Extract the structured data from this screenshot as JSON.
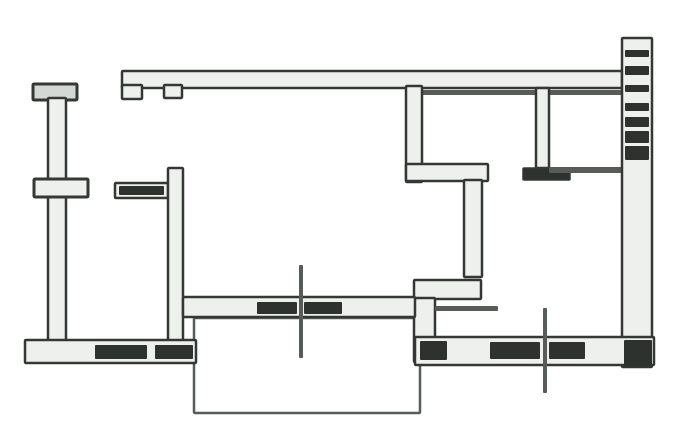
{
  "canvas": {
    "width": 697,
    "height": 446,
    "bg": "#ffffff"
  },
  "palette": {
    "paper": "#ffffff",
    "ink": "#343834",
    "ink_soft": "#575c58",
    "band": "#eef0ee",
    "band_shade": "#d4d8d4",
    "dark": "#2e322e"
  },
  "floorplan": {
    "kind": "apartment-floor-plan",
    "shapes": [
      {
        "name": "balcony-outline",
        "type": "band",
        "x": 194,
        "y": 318,
        "w": 226,
        "h": 95,
        "fill": "paper",
        "stroke": "ink_soft",
        "sw": 2.5
      },
      {
        "name": "top-exterior-wall",
        "type": "band",
        "x": 122,
        "y": 71,
        "w": 500,
        "h": 17,
        "fill": "band",
        "stroke": "ink",
        "sw": 2.5
      },
      {
        "name": "top-wall-left-jamb",
        "type": "band",
        "x": 122,
        "y": 85,
        "w": 20,
        "h": 14,
        "fill": "band",
        "stroke": "ink",
        "sw": 2.5
      },
      {
        "name": "top-wall-second-jamb",
        "type": "band",
        "x": 164,
        "y": 85,
        "w": 18,
        "h": 13,
        "fill": "band",
        "stroke": "ink",
        "sw": 2.5
      },
      {
        "name": "top-wall-inner-line",
        "type": "fill",
        "x": 420,
        "y": 90,
        "w": 202,
        "h": 5,
        "fill": "ink_soft"
      },
      {
        "name": "left-wall-top-cap",
        "type": "band",
        "x": 33,
        "y": 84,
        "w": 44,
        "h": 16,
        "fill": "band_shade",
        "stroke": "ink",
        "sw": 3
      },
      {
        "name": "left-exterior-wall",
        "type": "band",
        "x": 48,
        "y": 98,
        "w": 18,
        "h": 246,
        "fill": "band",
        "stroke": "ink",
        "sw": 2.5
      },
      {
        "name": "left-wall-pier",
        "type": "band",
        "x": 34,
        "y": 179,
        "w": 54,
        "h": 18,
        "fill": "band",
        "stroke": "ink",
        "sw": 3
      },
      {
        "name": "entry-wall-segment",
        "type": "band",
        "x": 115,
        "y": 183,
        "w": 53,
        "h": 15,
        "fill": "band",
        "stroke": "ink",
        "sw": 2.5
      },
      {
        "name": "entry-wall-fill",
        "type": "fill",
        "x": 119,
        "y": 186,
        "w": 45,
        "h": 9,
        "fill": "dark"
      },
      {
        "name": "hall-partition-wall",
        "type": "band",
        "x": 168,
        "y": 168,
        "w": 15,
        "h": 175,
        "fill": "band",
        "stroke": "ink",
        "sw": 2.5
      },
      {
        "name": "bottom-left-exterior-wall",
        "type": "band",
        "x": 25,
        "y": 340,
        "w": 171,
        "h": 23,
        "fill": "band",
        "stroke": "ink",
        "sw": 2.5
      },
      {
        "name": "bottom-left-window-fill-a",
        "type": "fill",
        "x": 95,
        "y": 345,
        "w": 52,
        "h": 14,
        "fill": "dark"
      },
      {
        "name": "bottom-left-window-fill-b",
        "type": "fill",
        "x": 155,
        "y": 345,
        "w": 38,
        "h": 14,
        "fill": "dark"
      },
      {
        "name": "kitchen-partition-wall",
        "type": "band",
        "x": 406,
        "y": 86,
        "w": 16,
        "h": 96,
        "fill": "band",
        "stroke": "ink",
        "sw": 2.5
      },
      {
        "name": "kitchen-lower-wall",
        "type": "band",
        "x": 406,
        "y": 164,
        "w": 82,
        "h": 17,
        "fill": "band",
        "stroke": "ink",
        "sw": 2.5
      },
      {
        "name": "corridor-wall",
        "type": "band",
        "x": 464,
        "y": 180,
        "w": 18,
        "h": 97,
        "fill": "band",
        "stroke": "ink",
        "sw": 2.5
      },
      {
        "name": "corridor-step-wall",
        "type": "band",
        "x": 414,
        "y": 280,
        "w": 67,
        "h": 19,
        "fill": "band",
        "stroke": "ink",
        "sw": 2.5
      },
      {
        "name": "corridor-step-wall-lower",
        "type": "band",
        "x": 414,
        "y": 298,
        "w": 21,
        "h": 64,
        "fill": "band",
        "stroke": "ink",
        "sw": 2.5
      },
      {
        "name": "threshold-line",
        "type": "fill",
        "x": 435,
        "y": 306,
        "w": 63,
        "h": 5,
        "fill": "ink_soft"
      },
      {
        "name": "living-room-south-wall",
        "type": "band",
        "x": 183,
        "y": 297,
        "w": 232,
        "h": 20,
        "fill": "band",
        "stroke": "ink",
        "sw": 2.5
      },
      {
        "name": "south-wall-window-fill-a",
        "type": "fill",
        "x": 257,
        "y": 302,
        "w": 40,
        "h": 12,
        "fill": "dark"
      },
      {
        "name": "south-wall-window-fill-b",
        "type": "fill",
        "x": 304,
        "y": 302,
        "w": 38,
        "h": 12,
        "fill": "dark"
      },
      {
        "name": "bath-partition-wall",
        "type": "band",
        "x": 536,
        "y": 88,
        "w": 13,
        "h": 80,
        "fill": "band",
        "stroke": "ink",
        "sw": 2.5
      },
      {
        "name": "bath-door-jamb",
        "type": "band",
        "x": 523,
        "y": 168,
        "w": 47,
        "h": 12,
        "fill": "dark",
        "stroke": "ink",
        "sw": 1.5
      },
      {
        "name": "bath-south-wall-line",
        "type": "fill",
        "x": 549,
        "y": 167,
        "w": 79,
        "h": 6,
        "fill": "ink_soft"
      },
      {
        "name": "right-exterior-wall",
        "type": "band",
        "x": 622,
        "y": 38,
        "w": 30,
        "h": 329,
        "fill": "band",
        "stroke": "ink",
        "sw": 2.5
      },
      {
        "name": "right-wall-hatch-1",
        "type": "fill",
        "x": 625,
        "y": 50,
        "w": 24,
        "h": 7,
        "fill": "dark"
      },
      {
        "name": "right-wall-hatch-2",
        "type": "fill",
        "x": 625,
        "y": 66,
        "w": 24,
        "h": 9,
        "fill": "dark"
      },
      {
        "name": "right-wall-hatch-3",
        "type": "fill",
        "x": 625,
        "y": 85,
        "w": 24,
        "h": 7,
        "fill": "dark"
      },
      {
        "name": "right-wall-hatch-4",
        "type": "fill",
        "x": 625,
        "y": 103,
        "w": 24,
        "h": 8,
        "fill": "dark"
      },
      {
        "name": "right-wall-hatch-5",
        "type": "fill",
        "x": 625,
        "y": 117,
        "w": 24,
        "h": 10,
        "fill": "dark"
      },
      {
        "name": "right-wall-hatch-6",
        "type": "fill",
        "x": 625,
        "y": 131,
        "w": 24,
        "h": 12,
        "fill": "dark"
      },
      {
        "name": "right-wall-hatch-7",
        "type": "fill",
        "x": 625,
        "y": 146,
        "w": 24,
        "h": 14,
        "fill": "dark"
      },
      {
        "name": "bottom-right-exterior-wall",
        "type": "band",
        "x": 415,
        "y": 337,
        "w": 239,
        "h": 28,
        "fill": "band",
        "stroke": "ink",
        "sw": 2.5
      },
      {
        "name": "bottom-right-window-fill-a",
        "type": "fill",
        "x": 420,
        "y": 341,
        "w": 27,
        "h": 19,
        "fill": "dark"
      },
      {
        "name": "bottom-right-window-fill-b",
        "type": "fill",
        "x": 490,
        "y": 342,
        "w": 50,
        "h": 17,
        "fill": "dark"
      },
      {
        "name": "bottom-right-window-fill-c",
        "type": "fill",
        "x": 549,
        "y": 342,
        "w": 36,
        "h": 17,
        "fill": "dark"
      },
      {
        "name": "bottom-right-corner-fill",
        "type": "fill",
        "x": 624,
        "y": 340,
        "w": 28,
        "h": 26,
        "fill": "dark"
      },
      {
        "name": "survey-cross-center",
        "type": "fill",
        "x": 299,
        "y": 265,
        "w": 4,
        "h": 93,
        "fill": "ink_soft"
      },
      {
        "name": "survey-cross-right",
        "type": "fill",
        "x": 543,
        "y": 308,
        "w": 4,
        "h": 85,
        "fill": "ink_soft"
      }
    ]
  }
}
